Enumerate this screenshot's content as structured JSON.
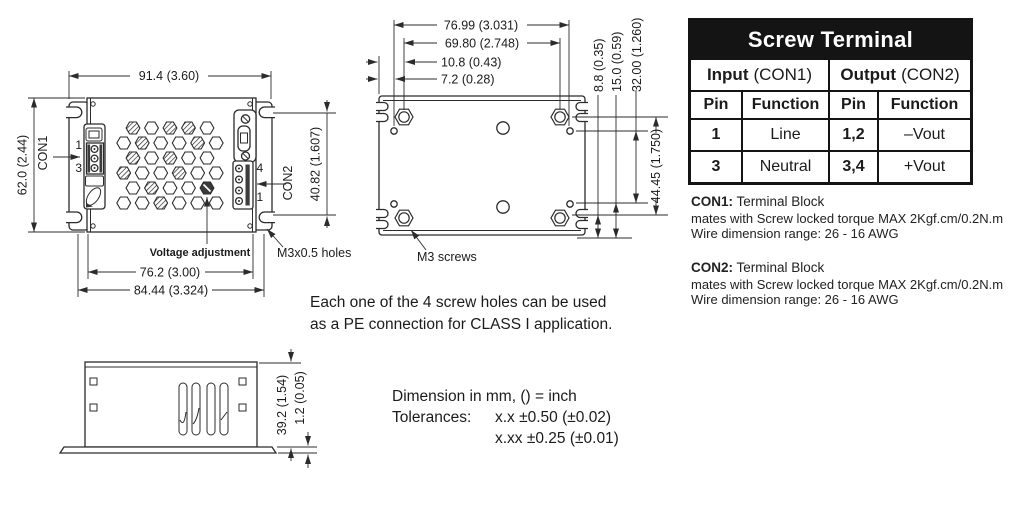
{
  "table": {
    "title": "Screw Terminal",
    "input_group": "Input",
    "input_group_suffix": "(CON1)",
    "output_group": "Output",
    "output_group_suffix": "(CON2)",
    "pin_header": "Pin",
    "function_header": "Function",
    "rows": [
      {
        "in_pin": "1",
        "in_func": "Line",
        "out_pin": "1,2",
        "out_func": "–Vout"
      },
      {
        "in_pin": "3",
        "in_func": "Neutral",
        "out_pin": "3,4",
        "out_func": "+Vout"
      }
    ]
  },
  "connector_notes": [
    {
      "label": "CON1:",
      "type": "Terminal Block",
      "torque": "mates with Screw locked torque MAX 2Kgf.cm/0.2N.m",
      "wire": "Wire dimension range: 26 - 16 AWG"
    },
    {
      "label": "CON2:",
      "type": "Terminal Block",
      "torque": "mates with Screw locked torque MAX 2Kgf.cm/0.2N.m",
      "wire": "Wire dimension range: 26 - 16 AWG"
    }
  ],
  "center_notes": {
    "pe_line1": "Each one of the 4 screw holes can be used",
    "pe_line2": "as a PE connection for CLASS I application.",
    "units": "Dimension in mm, () = inch",
    "tolerances_label": "Tolerances:",
    "tolerance1": "x.x ±0.50 (±0.02)",
    "tolerance2": "x.xx ±0.25 (±0.01)"
  },
  "top_view": {
    "width_dim": "91.4 (3.60)",
    "height_dim": "62.0 (2.44)",
    "con_height_dim": "40.82 (1.607)",
    "inner_width_dim": "76.2 (3.00)",
    "outer_width_dim": "84.44 (3.324)",
    "con1": "CON1",
    "con2": "CON2",
    "con1_pin_top": "1",
    "con1_pin_bottom": "3",
    "con2_pin_top": "4",
    "con2_pin_bottom": "1",
    "voltage_adjustment": "Voltage adjustment",
    "m3_holes": "M3x0.5 holes"
  },
  "bottom_view": {
    "dims_top": [
      "76.99 (3.031)",
      "69.80 (2.748)",
      "10.8 (0.43)",
      "7.2 (0.28)"
    ],
    "dims_side": [
      "8.8 (0.35)",
      "15.0 (0.59)",
      "32.00 (1.260)",
      "44.45 (1.750)"
    ],
    "m3_screws": "M3 screws"
  },
  "side_view": {
    "height_dim": "39.2 (1.54)",
    "base_dim": "1.2 (0.05)"
  }
}
